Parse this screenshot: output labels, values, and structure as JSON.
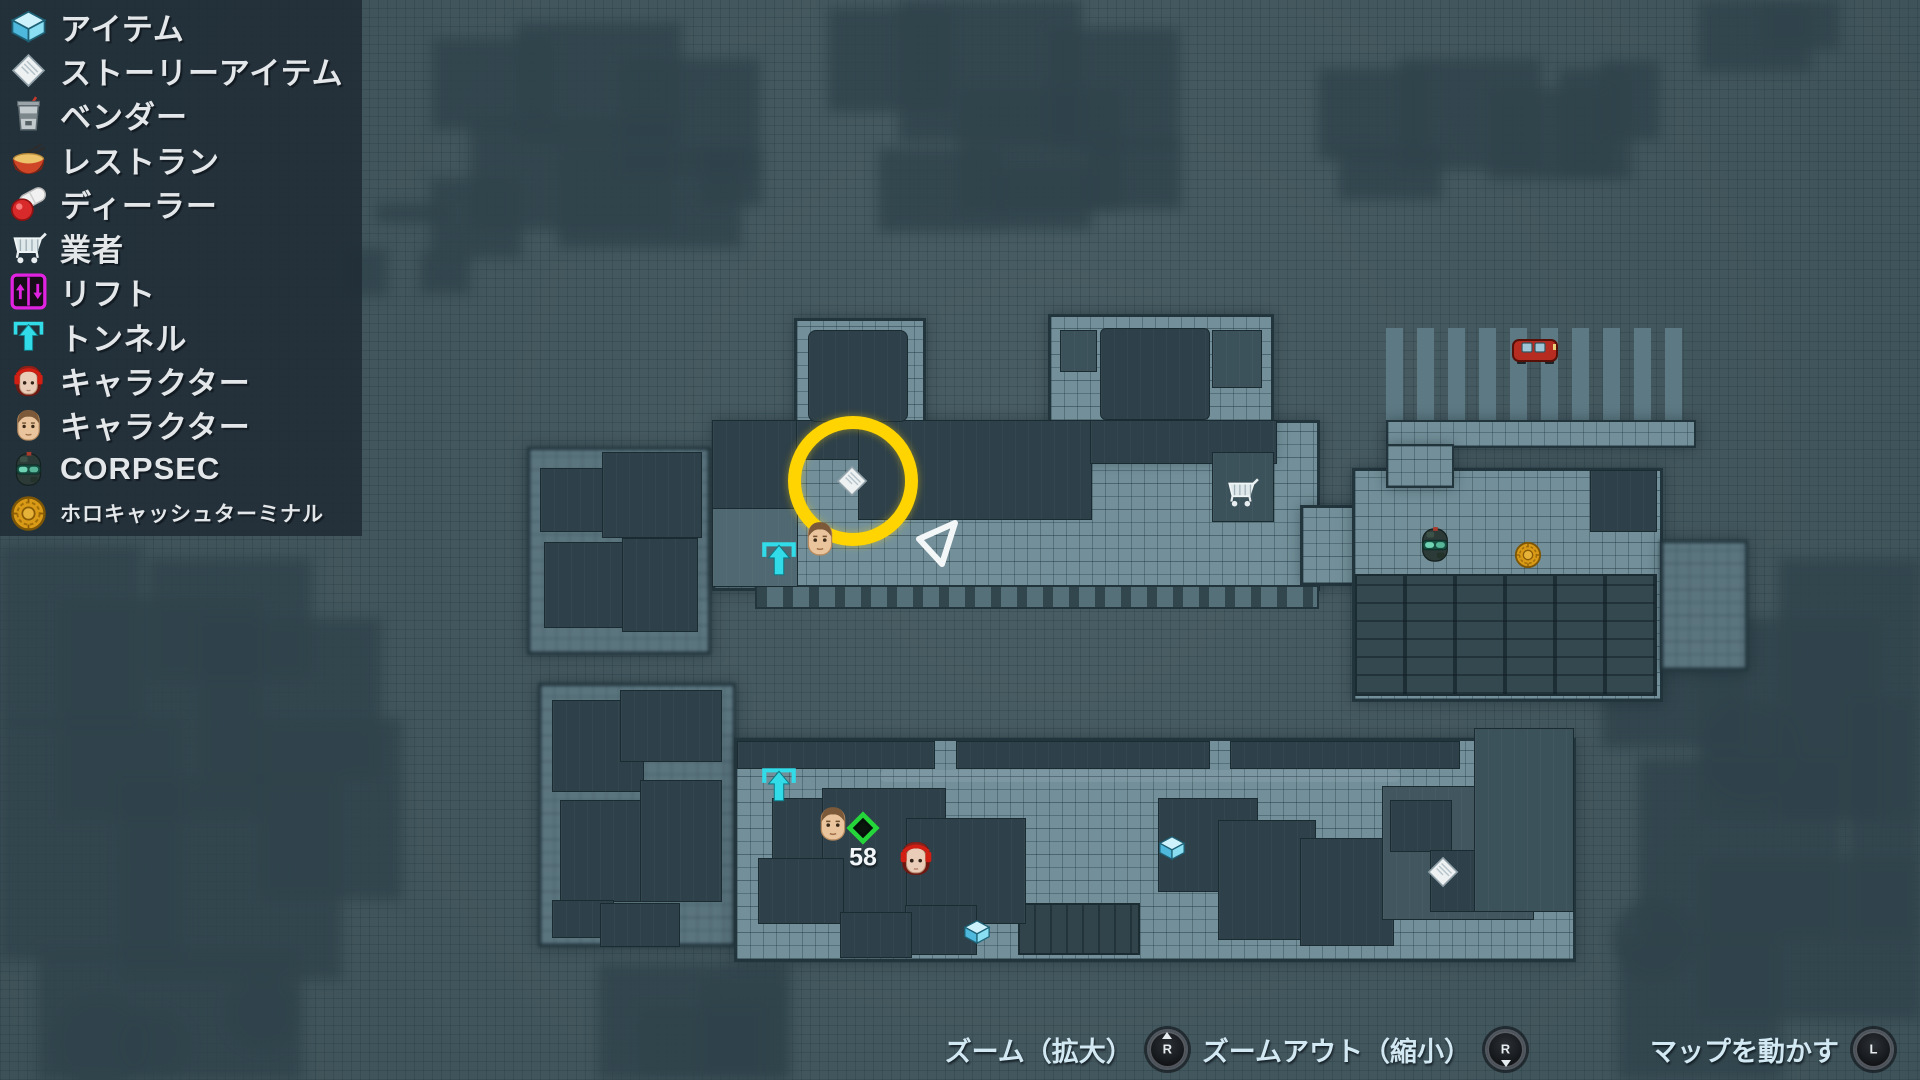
{
  "legend": {
    "items": [
      {
        "id": "item",
        "label": "アイテム",
        "icon": "item-box-icon"
      },
      {
        "id": "story-item",
        "label": "ストーリーアイテム",
        "icon": "story-item-icon"
      },
      {
        "id": "vendor",
        "label": "ベンダー",
        "icon": "vendor-cup-icon"
      },
      {
        "id": "restaurant",
        "label": "レストラン",
        "icon": "restaurant-bowl-icon"
      },
      {
        "id": "dealer",
        "label": "ディーラー",
        "icon": "dealer-pill-icon"
      },
      {
        "id": "trader",
        "label": "業者",
        "icon": "trader-cart-icon"
      },
      {
        "id": "lift",
        "label": "リフト",
        "icon": "lift-icon"
      },
      {
        "id": "tunnel",
        "label": "トンネル",
        "icon": "tunnel-icon"
      },
      {
        "id": "character-female",
        "label": "キャラクター",
        "icon": "character-female-icon"
      },
      {
        "id": "character-male",
        "label": "キャラクター",
        "icon": "character-male-icon"
      },
      {
        "id": "corpsec",
        "label": "CORPSEC",
        "icon": "corpsec-icon"
      },
      {
        "id": "holocash-terminal",
        "label": "ホロキャッシュターミナル",
        "icon": "holocash-icon"
      }
    ]
  },
  "map": {
    "waypoint_label": "58"
  },
  "controls": {
    "items": [
      {
        "label": "ズーム（拡大）",
        "stick": "R",
        "direction": "up"
      },
      {
        "label": "ズームアウト（縮小）",
        "stick": "R",
        "direction": "down"
      },
      {
        "label": "マップを動かす",
        "stick": "L",
        "direction": "none"
      }
    ]
  },
  "colors": {
    "highlight_circle": "#ffd400",
    "map_background": "#45595f",
    "floor": "#73909a",
    "dark_room": "#2e4049",
    "legend_panel": "rgba(32,44,54,0.88)",
    "accent_cyan": "#32dbe8",
    "accent_magenta": "#e123e1",
    "waypoint_green": "#25d63a"
  }
}
